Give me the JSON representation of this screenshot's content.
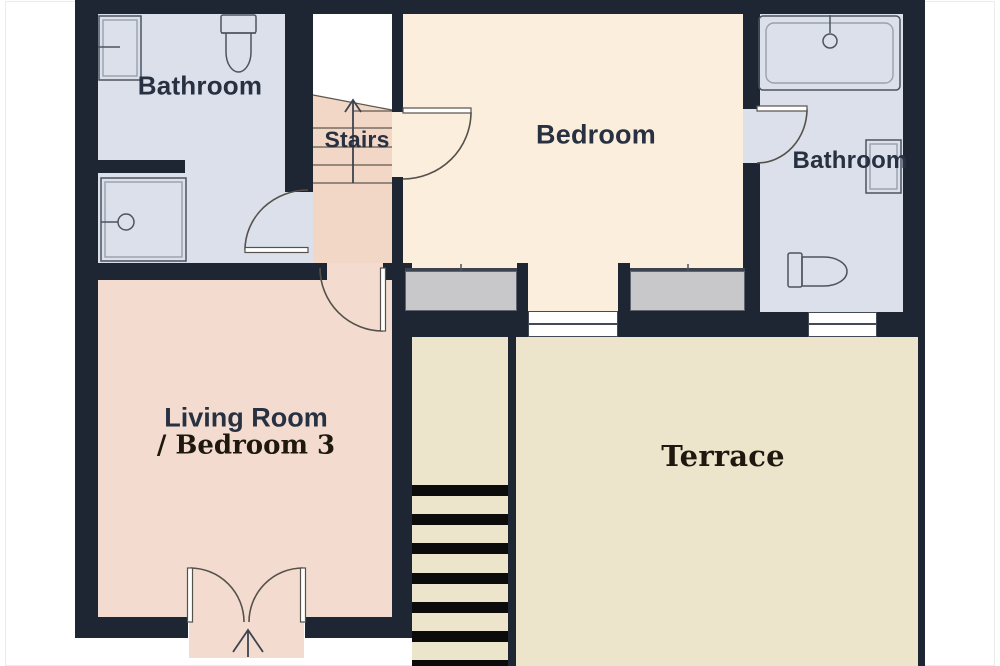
{
  "floorplan": {
    "rooms": {
      "bathroom_top_left": {
        "label": "Bathroom",
        "fixtures": [
          "sink",
          "toilet",
          "shower"
        ]
      },
      "stairs": {
        "label": "Stairs",
        "direction": "up"
      },
      "bedroom": {
        "label": "Bedroom"
      },
      "bathroom_right": {
        "label": "Bathroom",
        "fixtures": [
          "bathtub",
          "shower-head",
          "sink",
          "toilet"
        ]
      },
      "living_room": {
        "label_line1": "Living Room",
        "label_line2": "/ Bedroom 3"
      },
      "terrace": {
        "label": "Terrace"
      }
    },
    "colors": {
      "wall": "#1d2632",
      "bathroom_floor": "#dbe0eb",
      "hall_floor": "#f3d7c6",
      "living_floor": "#f3dccf",
      "bedroom_floor": "#fceedd",
      "terrace_floor": "#ece4cb",
      "window_fill": "#c8c8ca",
      "stair_tread": "#0b0b0b",
      "door_line": "#55514b",
      "fixture_line": "#4c5461",
      "label_sans_color": "#273142",
      "label_serif_color": "#1f180e"
    }
  }
}
